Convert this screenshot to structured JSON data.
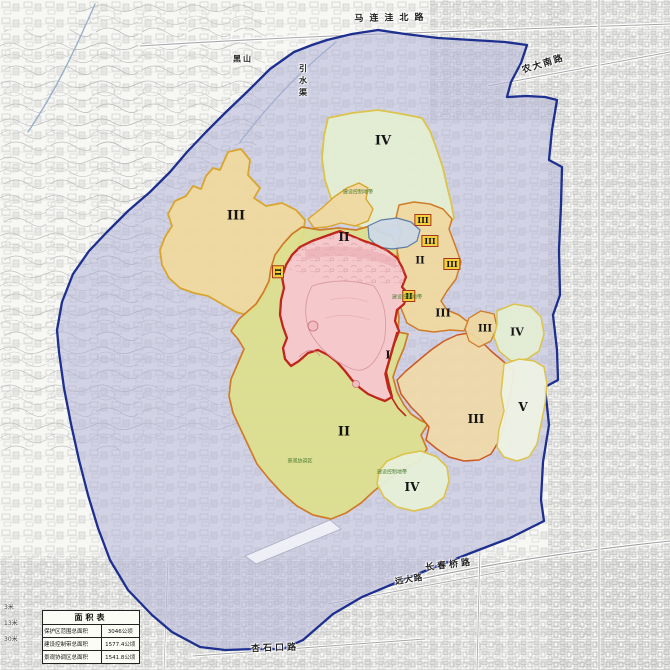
{
  "legend": {
    "title": "面积表",
    "rows": [
      {
        "label": "保护区范围总面积",
        "value": "3046公顷"
      },
      {
        "label": "建设控制带总面积",
        "value": "1577.4公顷"
      },
      {
        "label": "景观协调区总面积",
        "value": "1541.8公顷"
      }
    ]
  },
  "roads": {
    "malianwa": "马连洼北路",
    "nongda": "农大南路",
    "changchunqiao": "长春桥路",
    "yuanda": "远大路",
    "xingshikou": "杏石口路",
    "yinshuiqu": "引水渠",
    "heishan": "黑山"
  },
  "markers": [
    {
      "t": "IV"
    },
    {
      "t": "III"
    },
    {
      "t": "II"
    },
    {
      "t": "III"
    },
    {
      "t": "III"
    },
    {
      "t": "III"
    },
    {
      "t": "II"
    },
    {
      "t": "II"
    },
    {
      "t": "II"
    },
    {
      "t": "III"
    },
    {
      "t": "III"
    },
    {
      "t": "IV"
    },
    {
      "t": "I"
    },
    {
      "t": "III"
    },
    {
      "t": "V"
    },
    {
      "t": "II"
    },
    {
      "t": "IV"
    }
  ],
  "fineprint": [
    {
      "t": "建设控制地带"
    },
    {
      "t": "建设控制地带"
    },
    {
      "t": "建设控制地带"
    },
    {
      "t": "景观协调区"
    }
  ],
  "edge_marks": [
    {
      "t": "3米"
    },
    {
      "t": "13米"
    },
    {
      "t": "30米"
    }
  ],
  "colors": {
    "coordination_zone": "#b0b0d8",
    "boundary_blue": "#1d2f8f",
    "core_pink": "#f5c9cb",
    "core_border_red": "#c0271c",
    "buffer_green": "#dde08d",
    "buffer_tan": "#efd9a0",
    "pale_green": "#e4eed2",
    "box_yellow": "#f1cf3d"
  }
}
